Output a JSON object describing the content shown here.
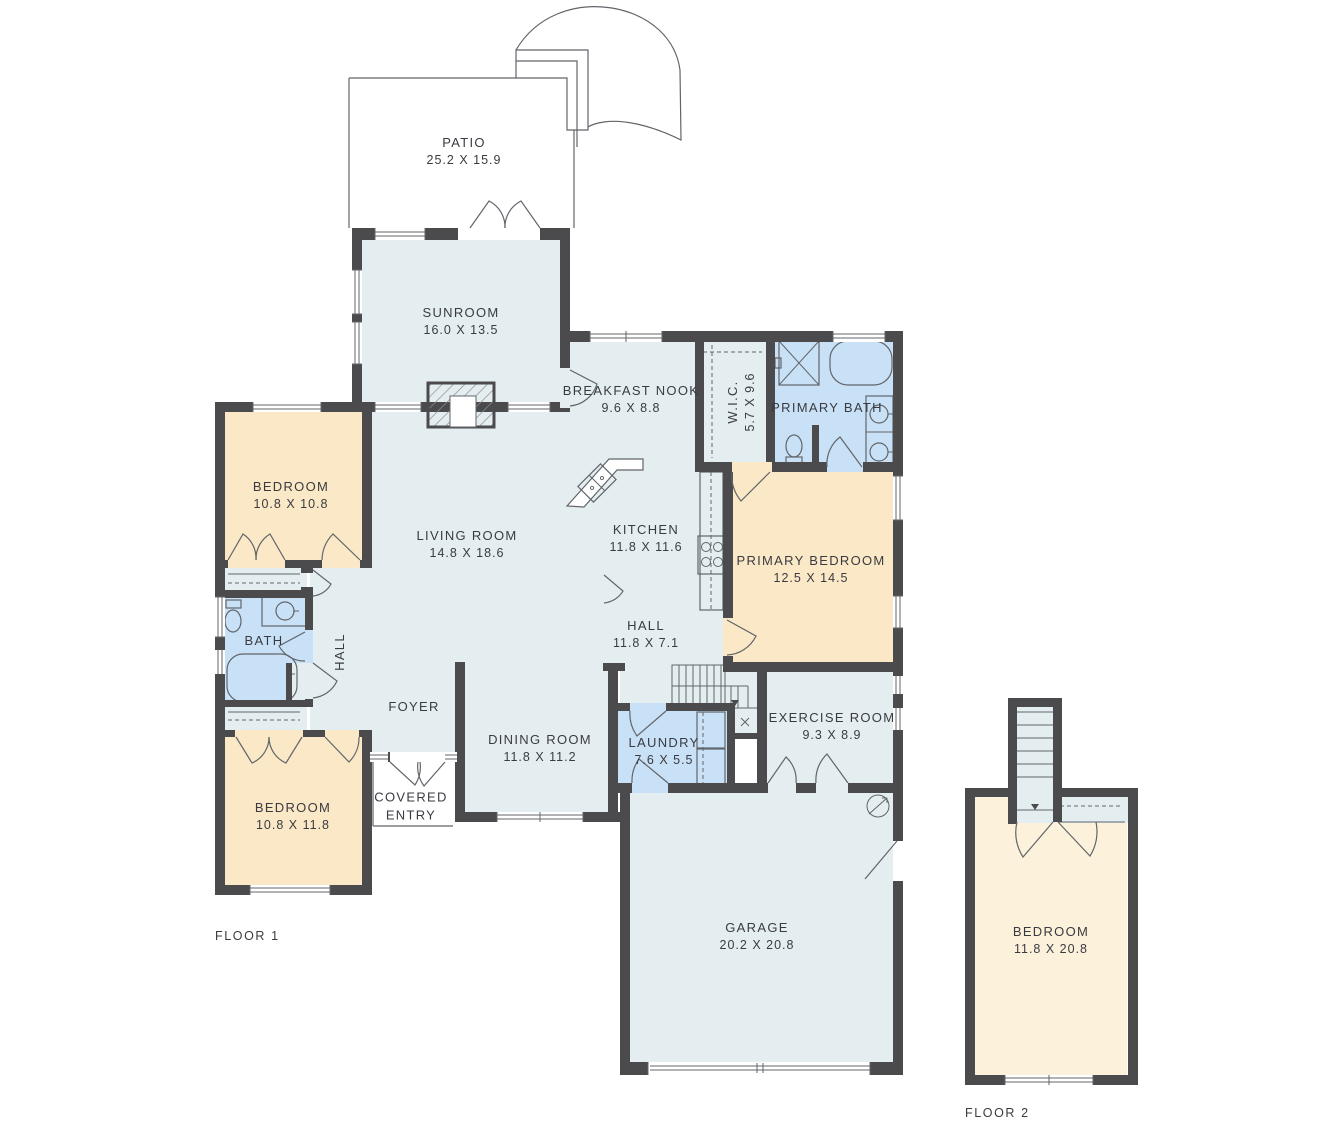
{
  "colors": {
    "wall": "#4b4b4e",
    "living": "#e4eef0",
    "bedroom": "#fae8c6",
    "bedroom_upper": "#fcf1da",
    "bathroom": "#c9e1f6",
    "line": "#61656a",
    "label_text": "#3a3b41"
  },
  "floor1_label": "FLOOR 1",
  "floor2_label": "FLOOR 2",
  "rooms": {
    "patio": {
      "name": "PATIO",
      "dims": "25.2 X 15.9"
    },
    "sunroom": {
      "name": "SUNROOM",
      "dims": "16.0 X 13.5"
    },
    "breakfast_nook": {
      "name": "BREAKFAST NOOK",
      "dims": "9.6 X 8.8"
    },
    "wic": {
      "name": "W.I.C.",
      "dims": "5.7 X 9.6"
    },
    "primary_bath": {
      "name": "PRIMARY BATH"
    },
    "bedroom1": {
      "name": "BEDROOM",
      "dims": "10.8 X 10.8"
    },
    "living_room": {
      "name": "LIVING ROOM",
      "dims": "14.8 X 18.6"
    },
    "kitchen": {
      "name": "KITCHEN",
      "dims": "11.8 X 11.6"
    },
    "primary_bedroom": {
      "name": "PRIMARY BEDROOM",
      "dims": "12.5 X 14.5"
    },
    "bath": {
      "name": "BATH"
    },
    "hall_side": {
      "name": "HALL"
    },
    "hall": {
      "name": "HALL",
      "dims": "11.8 X 7.1"
    },
    "foyer": {
      "name": "FOYER"
    },
    "dining_room": {
      "name": "DINING ROOM",
      "dims": "11.8 X 11.2"
    },
    "laundry": {
      "name": "LAUNDRY",
      "dims": "7.6 X 5.5"
    },
    "exercise_room": {
      "name": "EXERCISE ROOM",
      "dims": "9.3 X 8.9"
    },
    "covered_entry": {
      "name": "COVERED ENTRY"
    },
    "bedroom2": {
      "name": "BEDROOM",
      "dims": "10.8 X 11.8"
    },
    "garage": {
      "name": "GARAGE",
      "dims": "20.2 X 20.8"
    },
    "bedroom_f2": {
      "name": "BEDROOM",
      "dims": "11.8 X 20.8"
    }
  }
}
